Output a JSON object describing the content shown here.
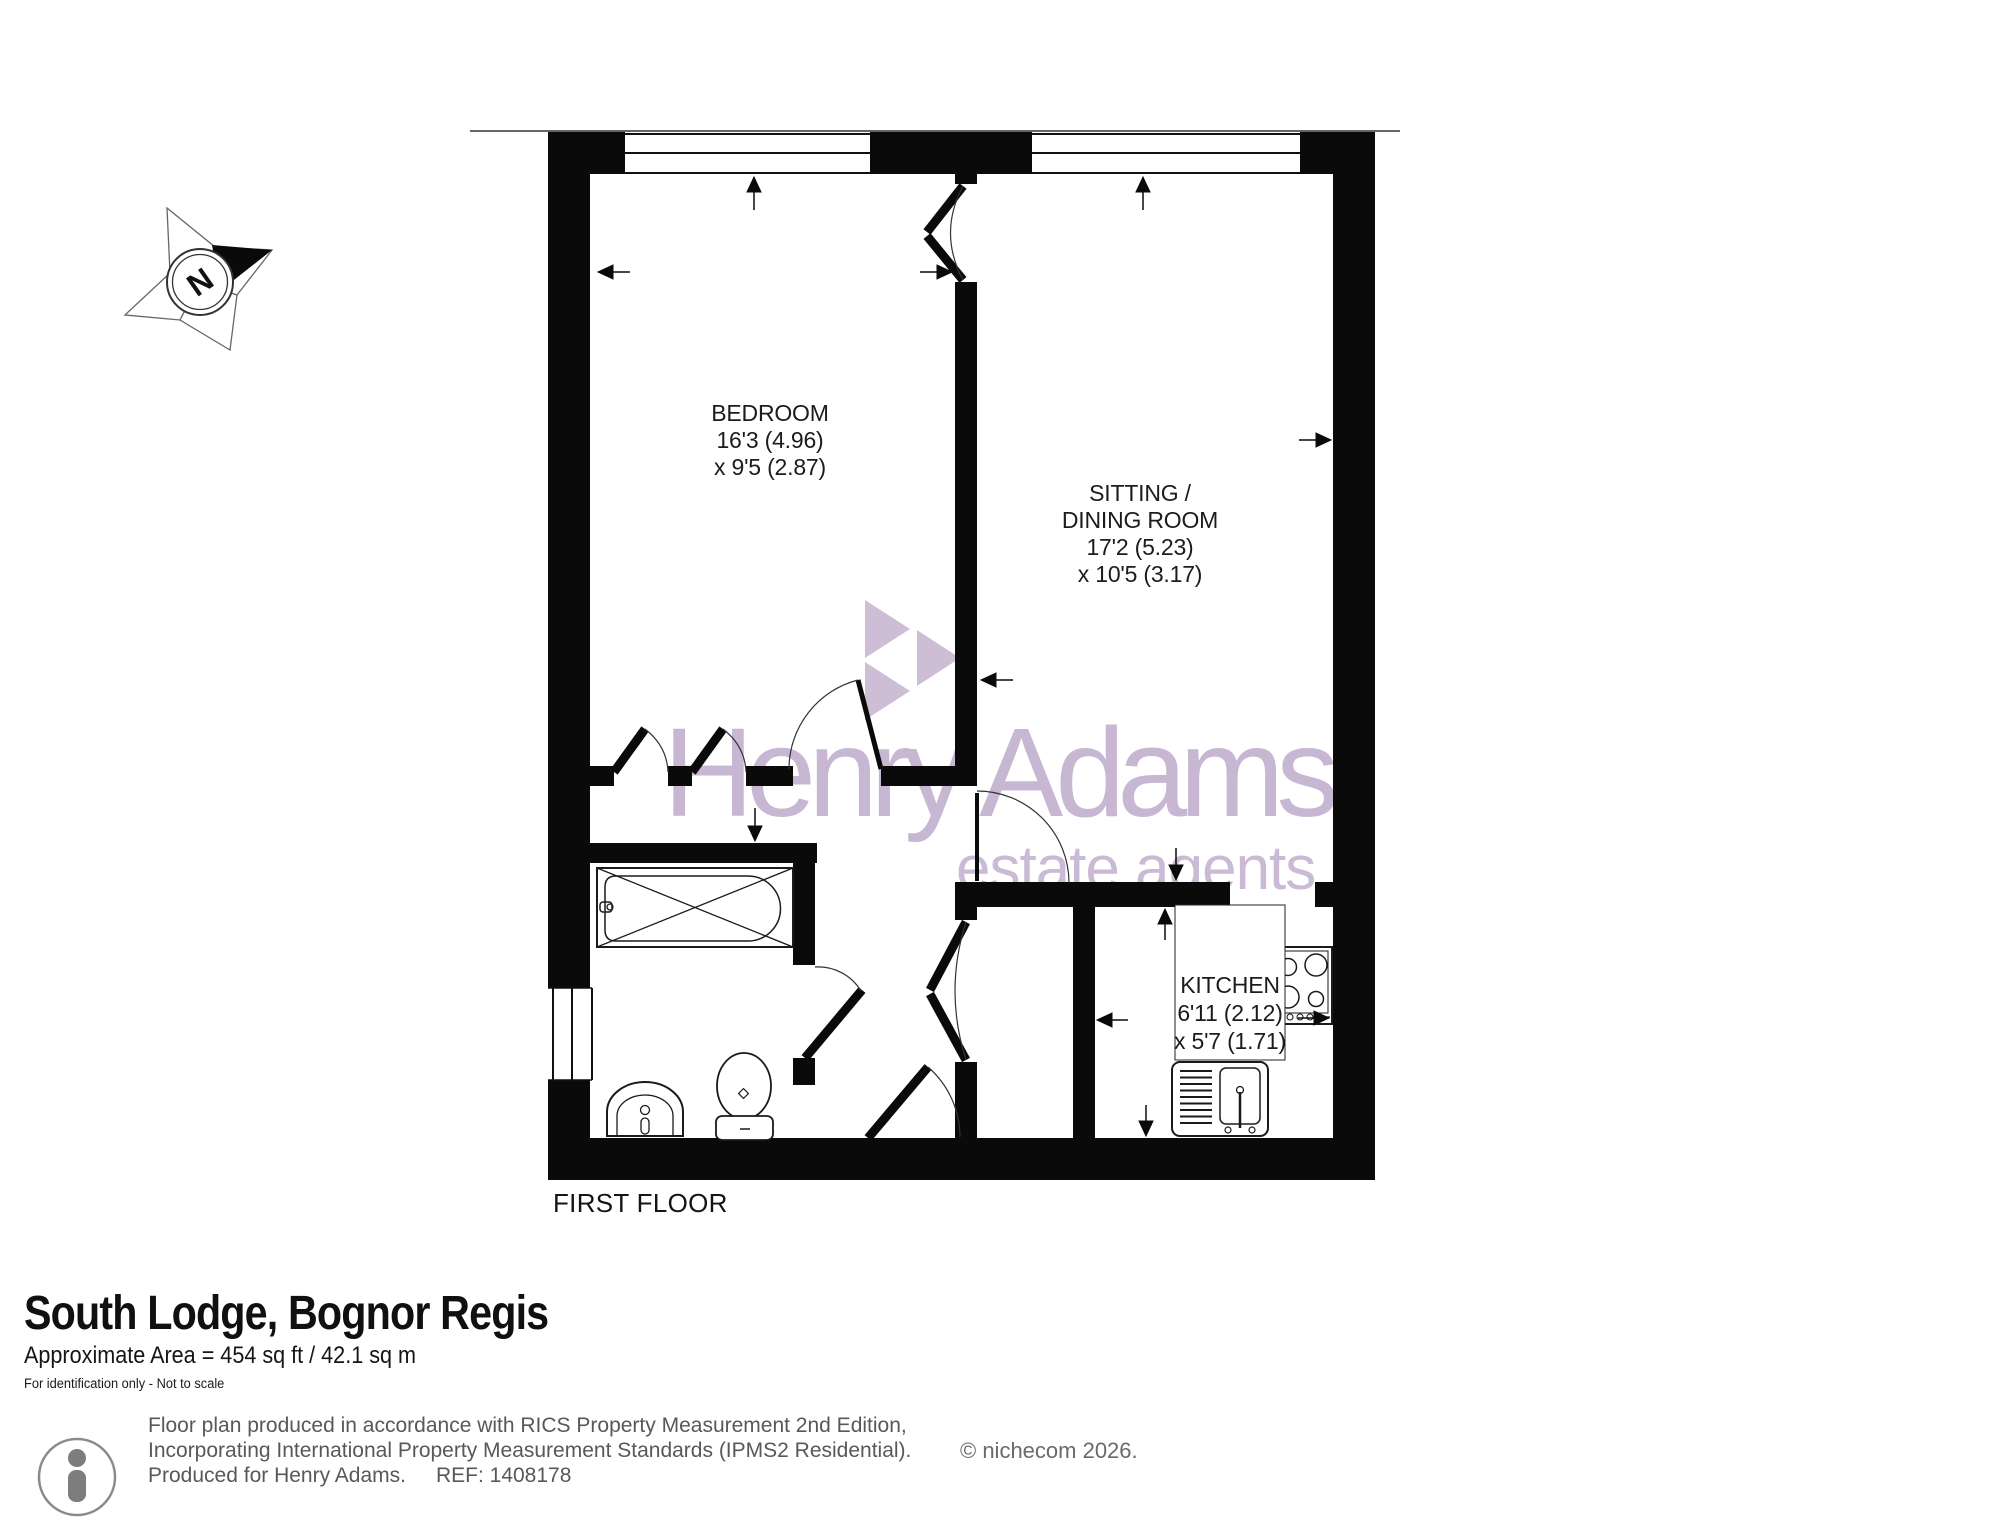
{
  "title_block": {
    "title": "South Lodge, Bognor Regis",
    "area_line": "Approximate Area = 454 sq ft / 42.1 sq m",
    "disclaimer": "For identification only - Not to scale"
  },
  "floor_label": "FIRST FLOOR",
  "rooms": {
    "bedroom": {
      "line1": "BEDROOM",
      "line2": "16'3 (4.96)",
      "line3": "x 9'5 (2.87)"
    },
    "sitting": {
      "line1": "SITTING /",
      "line2": "DINING ROOM",
      "line3": "17'2 (5.23)",
      "line4": "x 10'5 (3.17)"
    },
    "kitchen": {
      "line1": "KITCHEN",
      "line2": "6'11 (2.12)",
      "line3": "x 5'7 (1.71)"
    }
  },
  "watermark": {
    "brand": "Henry Adams",
    "tagline": "estate agents",
    "color": "#c8b7d2"
  },
  "compass": {
    "north_letter": "N"
  },
  "footer": {
    "line1": "Floor plan produced in accordance with RICS Property Measurement 2nd Edition,",
    "line2": "Incorporating International Property Measurement Standards (IPMS2 Residential).",
    "copyright": "© nichecom 2026.",
    "line3": "Produced for Henry Adams.",
    "ref": "REF: 1408178"
  },
  "colors": {
    "wall": "#0a0a0a",
    "line": "#1a1a1a",
    "watermark": "#c8b7d2",
    "footer_text": "#58585a"
  }
}
